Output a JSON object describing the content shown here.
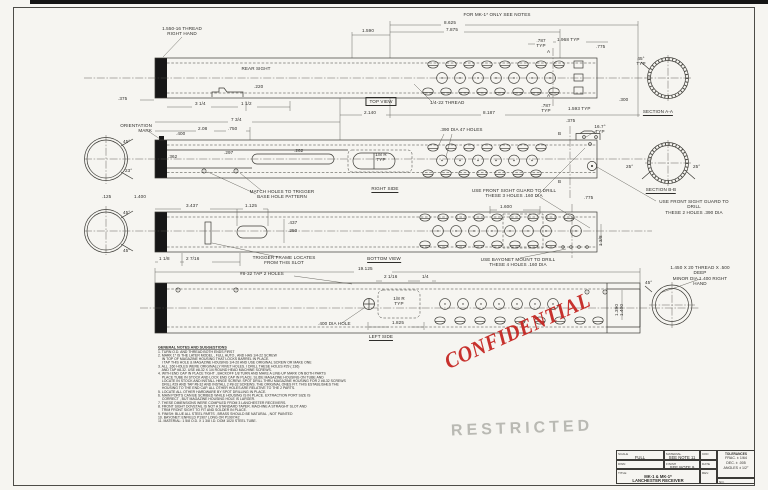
{
  "stamps": {
    "confidential": "CONFIDENTIAL",
    "restricted": "RESTRICTED",
    "confidential_color": "#c4211d",
    "restricted_color": "#8e8e87"
  },
  "views": {
    "top": "TOP VIEW",
    "right": "RIGHT SIDE",
    "bottom": "BOTTOM VIEW",
    "left": "LEFT SIDE",
    "section_aa": "SECTION A-A",
    "section_bb": "SECTION B-B"
  },
  "callouts": {
    "thread_end": "1.550-16 THREAD\nRIGHT HAND",
    "mk1_note": "FOR MK-1* ONLY SEE NOTES",
    "rear_sight": "REAR SIGHT",
    "orientation": "ORIENTATION\nMARK",
    "holes47": ".390 DIA 47 HOLES",
    "quarter22": "1/4-22 THREAD",
    "match_holes": "MATCH HOLES TO TRIGGER\nBASE HOLE PATTERN",
    "fsg3": "USE FRONT SIGHT GUARD TO DRILL\nTHESE 3 HOLES .160 DIA",
    "fsg2": "USE FRONT SIGHT GUARD TO DRILL\nTHESE 2 HOLES .390 DIA",
    "trigger_frame": "TRIGGER FRAME LOCATES\nFROM THIS SLOT",
    "bayonet": "USE BAYONET MOUNT TO DRILL\nTHESE 4 HOLES .160 DIA",
    "tap2": "#8-32 TAP 2 HOLES",
    "hole400": ".400 DIA HOLE",
    "thread_right": "1.450 X 20 THREAD X .500 DEEP\nMINOR DIA 1.400 RIGHT HAND",
    "r18_typ": "1/8 R\nTYP",
    "deg167": "16.7°\nTYP",
    "deg45typ": "45°\nTYP"
  },
  "dims": {
    "d8625": "8.625",
    "d7875": "7.875",
    "d1590": "1.590",
    "d787": ".787\nTYP",
    "d1968": "1.968 TYP",
    "d775": ".775",
    "d300": ".300",
    "d1593": "1.593 TYP",
    "d8187": "8.187",
    "d2140": "2.140",
    "d375": ".375",
    "d314": "3 1/4",
    "d112": "1 1/2",
    "d220": ".220",
    "d734": "7 3/4",
    "d208": "2.08",
    "d750": ".750",
    "d400": ".400",
    "d362": ".362",
    "d297": ".297",
    "d262": ".262",
    "d125": ".125",
    "d1400": "1.400",
    "d3437": "3.437",
    "d1125": "1.125",
    "d437": ".437",
    "d250": ".250",
    "d118": "1 1/8",
    "d2716": "2 7/16",
    "d1600": "1.600",
    "d19125": "19.125",
    "d2116": "2 1/16",
    "d14": "1/4",
    "d1825": "1.825",
    "d_id": "1 3/8",
    "d_minor": "1.390\n1.400",
    "a": "A",
    "b": "B",
    "deg25": "25°",
    "deg45": "45°",
    "deg23": "23°"
  },
  "notes": {
    "title": "GENERAL NOTES AND SUGGESTIONS",
    "body": "1. TURN O.D. AND THREAD BOTH ENDS FIRST\n2. MARK 1* IS THE LATER MODEL , FULL AUTO , AND HAS 1/4-22 SCREW\n    IN TOP OF MAGAZINE HOUSING THAT LOCKS BARREL IN PLACE.\n    I TAP THIS HOLE & MAGAZINE HOUSING 1/4-20 AND USE ORIGINAL SCREW OR MAKE ONE\n3. ALL .160 HOLES WERE ORIGINALLY RIVET HOLES. I DRILL THESE HOLES #29 (.136)\n    AND TAP #8-32. USE #8-32 X 1/4 ROUND HEAD MACHINE SCREWS.\n4. WITH END CAP IN PLACE TIGHT , BACKOFF 1/8 TURN AND MAKE A LINE-UP MARK ON BOTH PARTS\n    PLACE TUBE IN STOCK AND LOCK END CAP IN PLACE. SLIDE MAGAZINE HOUSING ON TUBE AND\n    LOCATE IN STOCK AND INSTALL HINGE SCREW. SPOT DRILL THRU MAGAZINE HOUSING FOR 2 #8-32 SCREWS\n    DRILL #29 AND TAP #8-32 AND INSTALL 2 #8-32 SCREWS. THE ORIGINAL ONES FIT. THIS ESTABLISHES THE\n    HOUSING TO THE END CAP. ALL OTHER HOLES ARE RELATIVE TO THE 2 PARTS.\n5. LOCATE ALL OTHER HARDWARE BY SPOT DRILLING IN PLACE.\n6. MAIN PORTS CAN BE SCRIBED WHILE HOUSING IS IN PLACE. EXTRACTION PORT SIZE IS\n    CORRECT , BUT MAGAZINE HOUSING HOLE IS LARGER.\n7. THESE DIMENSIONS WERE COMPILED FROM 3 LANCHESTER RECEIVERS.\n8. FRONT SIGHT DOVETAIL IS NOT A STANDARD TAPER. MACHINE A STRAIGHT SLOT AND\n    TRIM FRONT SIGHT TO FIT AND SOLDER IN PLACE.\n9. FINISH: BLUE ALL STEEL PARTS , BRASS SHOULD BE NATURAL , NOT PAINTED\n10. BAYONET: ENFIELD P1907 LONG OR P1907/42\n11. MATERIAL: 1 5/8 O.D. X 1 3/8 I.D. DOM 1020 STEEL TUBE."
  },
  "title_block": {
    "scale_label": "SCALE",
    "scale": "FULL",
    "material_label": "MATERIAL",
    "material": "SEE NOTE 11",
    "finish_label": "FINISH",
    "finish": "SEE NOTE 9",
    "dwn_label": "DWN",
    "ckd_label": "CKD",
    "date_label": "DATE",
    "rev_label": "REV.",
    "no_label": "NO.",
    "title_label": "TITLE",
    "title_line1": "MK-1 & MK-1*",
    "title_line2": "LANCHESTER RECEIVER",
    "tolerances_label": "TOLERANCES",
    "tol1": "FRAC. ± 1/64",
    "tol2": "DEC. ± .005",
    "tol3": "ANGLES ± 1/2°"
  }
}
